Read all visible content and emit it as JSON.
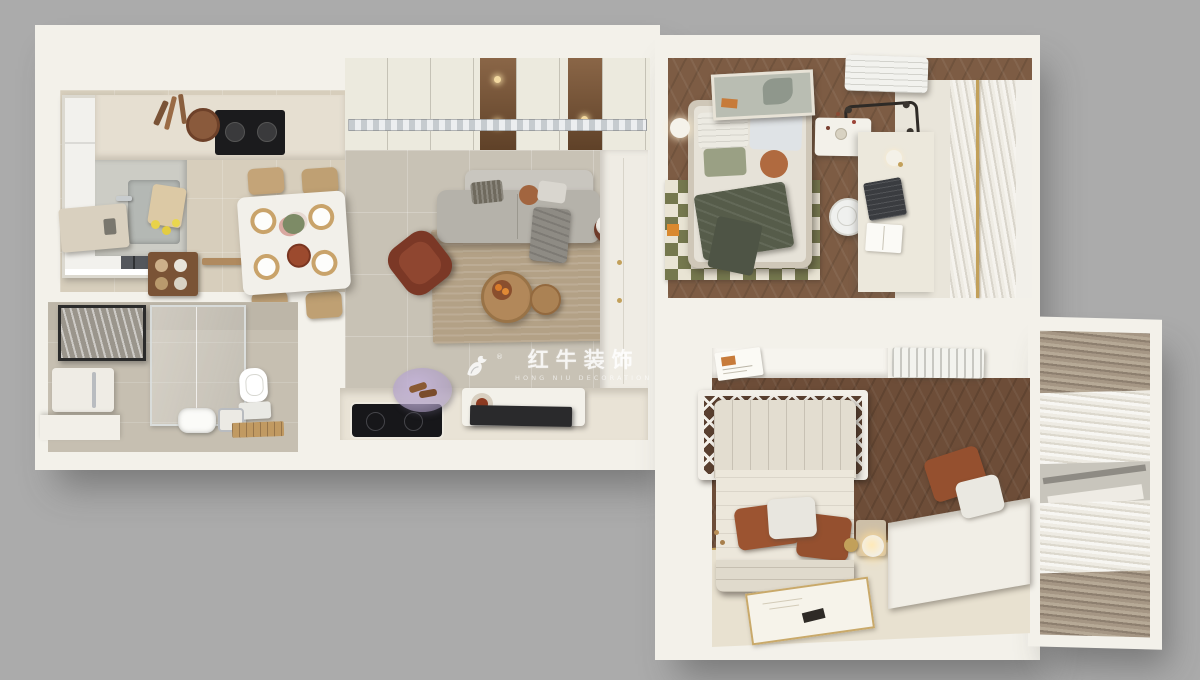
{
  "canvas": {
    "width": 1200,
    "height": 680,
    "background": "#ababab"
  },
  "watermark": {
    "logo": "bull-logo-icon",
    "registered": "®",
    "brand_cn": "红牛装饰",
    "brand_en": "HONG NIU DECORATION",
    "color": "#ffffff"
  },
  "palette": {
    "bg": "#ababab",
    "wall": "#f3f1ea",
    "wall-shade": "#e3e0d7",
    "floor-living": "#c8c2b5",
    "floor-kitchen": "#d7cebc",
    "floor-bath": "#c6bfb1",
    "wood": "#7d5c44",
    "wood-dark": "#6d4d38",
    "floor-cream": "#e8e1d0",
    "rug-tan": "#b3a186",
    "rug-cream": "#e9e4d4",
    "olive": "#75784e",
    "green-throw": "#565c4a",
    "terracotta": "#9c5431",
    "maroon": "#7b3826",
    "rattan": "#b2885a",
    "sofa-gray": "#b5b2aa",
    "glass-dark": "#54575c",
    "gold": "#c2a05a",
    "curtain-taupe": "#9d9081",
    "appliance-black": "#1b1b1d"
  }
}
